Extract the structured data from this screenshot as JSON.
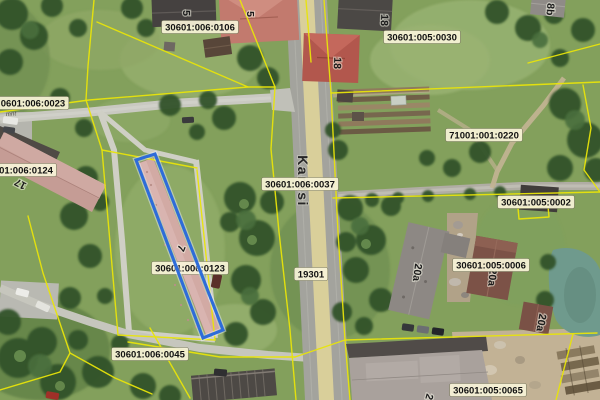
{
  "app": {
    "name": "cadastral-aerial-map"
  },
  "map": {
    "road_name": "Kantsi",
    "road_number": "19301",
    "street_fragment": "mnt",
    "selected_parcel_code": "30601:006:0123",
    "labels": [
      {
        "text": "30601:006:0106",
        "x": 200,
        "y": 27
      },
      {
        "text": "30601:005:0030",
        "x": 422,
        "y": 37
      },
      {
        "text": "0601:006:0023",
        "x": 33,
        "y": 103
      },
      {
        "text": "01:006:0124",
        "x": 26,
        "y": 170
      },
      {
        "text": "30601:006:0037",
        "x": 300,
        "y": 184
      },
      {
        "text": "71001:001:0220",
        "x": 484,
        "y": 135
      },
      {
        "text": "30601:005:0002",
        "x": 536,
        "y": 202
      },
      {
        "text": "30601:005:0006",
        "x": 491,
        "y": 265
      },
      {
        "text": "30601:006:0123",
        "x": 190,
        "y": 268
      },
      {
        "text": "30601:006:0045",
        "x": 150,
        "y": 354
      },
      {
        "text": "30601:005:0065",
        "x": 488,
        "y": 390
      },
      {
        "text": "19301",
        "x": 311,
        "y": 274
      }
    ],
    "building_numbers": [
      {
        "text": "5",
        "x": 183,
        "y": 13,
        "rot": 90
      },
      {
        "text": "5",
        "x": 247,
        "y": 14,
        "rot": 90
      },
      {
        "text": "18",
        "x": 381,
        "y": 20,
        "rot": 92
      },
      {
        "text": "18",
        "x": 334,
        "y": 63,
        "rot": 92
      },
      {
        "text": "8b",
        "x": 547,
        "y": 9,
        "rot": 95
      },
      {
        "text": "17",
        "x": 22,
        "y": 181,
        "rot": 208
      },
      {
        "text": "7",
        "x": 178,
        "y": 247,
        "rot": 112
      },
      {
        "text": "20a",
        "x": 414,
        "y": 272,
        "rot": 97
      },
      {
        "text": "20a",
        "x": 489,
        "y": 277,
        "rot": 95
      },
      {
        "text": "20a",
        "x": 538,
        "y": 322,
        "rot": 100
      },
      {
        "text": "2",
        "x": 426,
        "y": 396,
        "rot": 105
      }
    ]
  },
  "colors": {
    "boundary_yellow": "#e8e409",
    "selection_blue": "#2e6cd9",
    "label_bg": "#f8f3d7",
    "label_text": "#111111",
    "grass": "#83a05c",
    "road_fill": "#a3a39d",
    "road_center_stripe": "#d9cf9a",
    "water": "#6f9a8d"
  }
}
